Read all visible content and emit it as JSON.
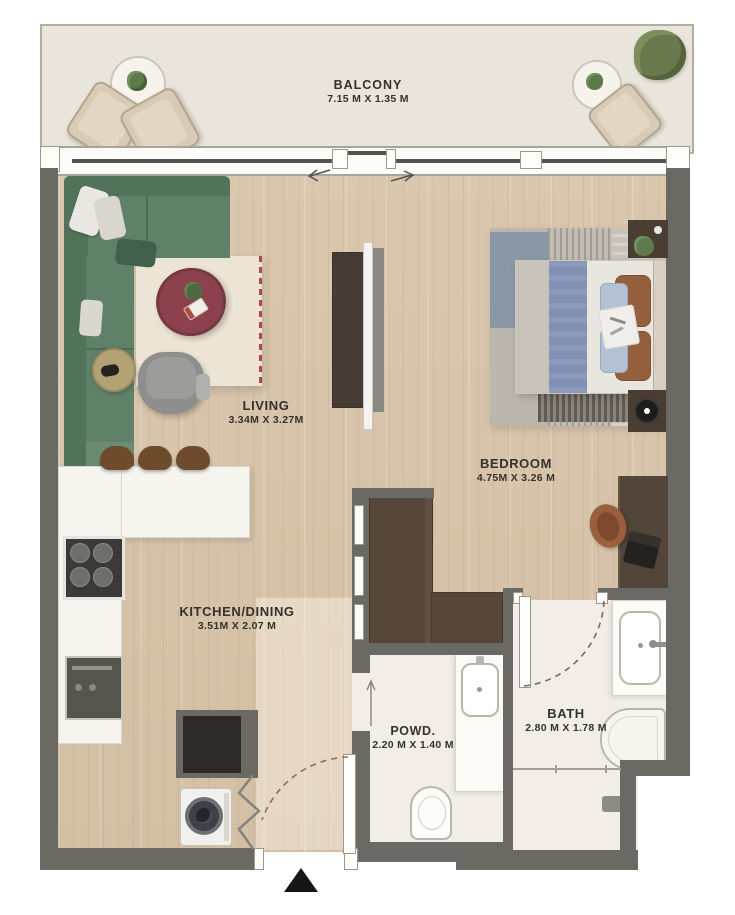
{
  "title": "apartment-floor-plan",
  "rooms": {
    "balcony": {
      "label": "BALCONY",
      "dims": "7.15 M X 1.35 M"
    },
    "living": {
      "label": "LIVING",
      "dims": "3.34M X 3.27M"
    },
    "bedroom": {
      "label": "BEDROOM",
      "dims": "4.75M X 3.26 M"
    },
    "kitchen": {
      "label": "KITCHEN/DINING",
      "dims": "3.51M X 2.07 M"
    },
    "powder": {
      "label": "POWD.",
      "dims": "2.20 M X 1.40 M"
    },
    "bath": {
      "label": "BATH",
      "dims": "2.80 M X 1.78 M"
    }
  },
  "colors": {
    "wall": "#6b6964",
    "wood_floor": "#d8c5ab",
    "tile_floor": "#f2eee7",
    "balcony_floor": "#eae5da",
    "sofa_green": "#5f8168",
    "rug_cream": "#ece4d4",
    "coffee_table_maroon": "#8d414c",
    "duvet_blue": "#8290b5",
    "counter_white": "#f6f4ee",
    "furniture_wood_brown": "#52453a",
    "accent_red_dash": "#b5483f",
    "entry_marker_black": "#161616"
  }
}
